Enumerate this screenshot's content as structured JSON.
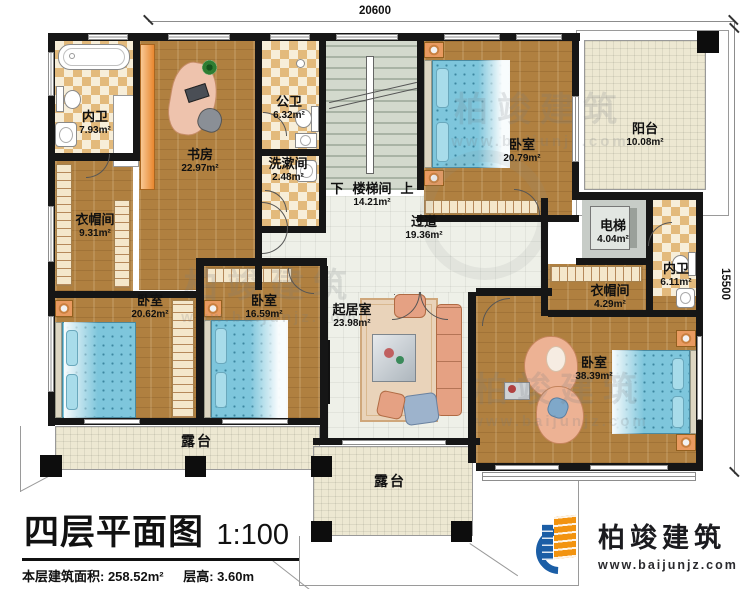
{
  "dimensions": {
    "top": "20600",
    "right": "15500"
  },
  "rooms": [
    {
      "name": "内卫",
      "area": "7.93m²"
    },
    {
      "name": "书房",
      "area": "22.97m²"
    },
    {
      "name": "公卫",
      "area": "6.32m²"
    },
    {
      "name": "洗漱间",
      "area": "2.48m²"
    },
    {
      "name": "楼梯间",
      "area": "14.21m²"
    },
    {
      "name": "卧室",
      "area": "20.79m²"
    },
    {
      "name": "阳台",
      "area": "10.08m²"
    },
    {
      "name": "电梯",
      "area": "4.04m²"
    },
    {
      "name": "内卫",
      "area": "6.11m²"
    },
    {
      "name": "衣帽间",
      "area": "9.31m²"
    },
    {
      "name": "衣帽间",
      "area": "4.29m²"
    },
    {
      "name": "卧室",
      "area": "20.62m²"
    },
    {
      "name": "卧室",
      "area": "16.59m²"
    },
    {
      "name": "过道",
      "area": "19.36m²"
    },
    {
      "name": "起居室",
      "area": "23.98m²"
    },
    {
      "name": "卧室",
      "area": "38.39m²"
    },
    {
      "name": "露台",
      "area": ""
    },
    {
      "name": "露台",
      "area": ""
    }
  ],
  "stairs": {
    "down": "下",
    "up": "上"
  },
  "title_block": {
    "title": "四层平面图",
    "scale": "1:100",
    "floor_area": "本层建筑面积: 258.52m²",
    "floor_height": "层高: 3.60m"
  },
  "brand": {
    "name": "柏竣建筑",
    "url": "www.baijunjz.com"
  },
  "watermark": {
    "name": "柏竣建筑",
    "url": "www.baijunjz.com"
  }
}
